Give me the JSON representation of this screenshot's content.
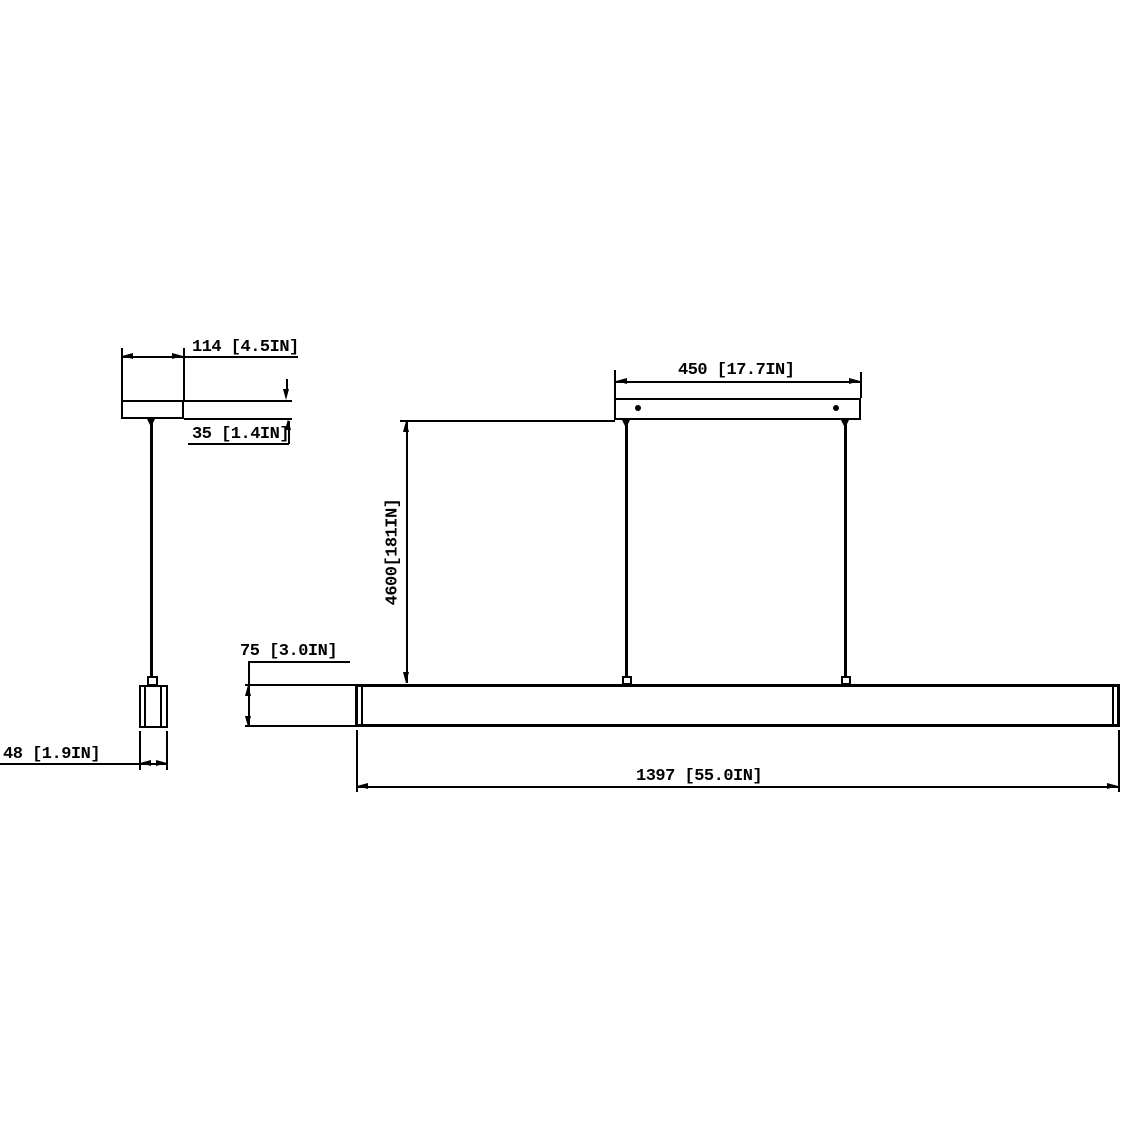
{
  "drawing": {
    "type": "technical-dimension-drawing",
    "subject": "linear pendant light fixture",
    "background_color": "#ffffff",
    "line_color": "#000000",
    "side_view": {
      "canopy_width_label": "114 [4.5IN]",
      "canopy_height_label": "35 [1.4IN]",
      "cylinder_width_label": "48 [1.9IN]"
    },
    "front_view": {
      "canopy_width_label": "450 [17.7IN]",
      "suspension_height_label": "4600[181IN]",
      "fixture_height_label": "75 [3.0IN]",
      "fixture_length_label": "1397 [55.0IN]"
    }
  }
}
